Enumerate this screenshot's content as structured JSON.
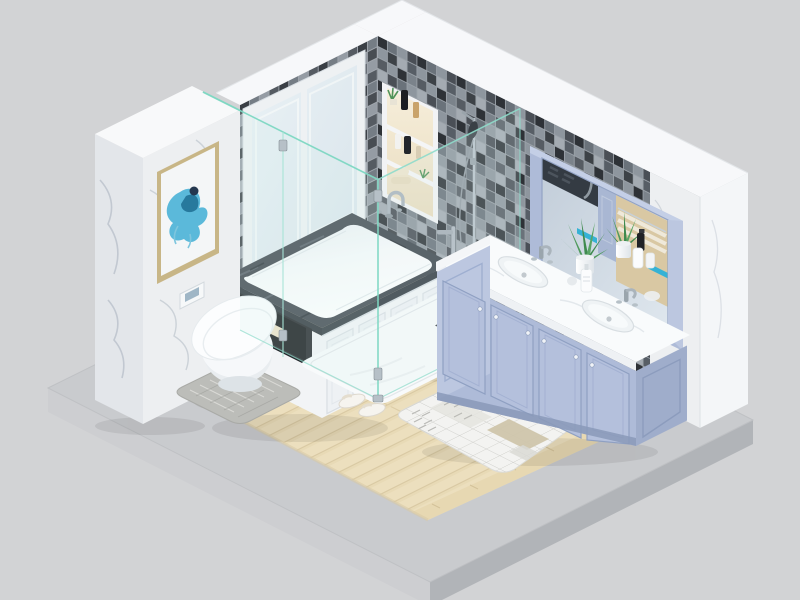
{
  "scene": {
    "kind": "3d-isometric-room-render",
    "room": "bathroom",
    "view": "isometric cutaway, two walls visible, transparent-style studio background",
    "background": "#d2d3d5"
  },
  "palette": {
    "background": "#d2d3d5",
    "slab_top": "#c9cbce",
    "slab_left": "#cdced1",
    "slab_right": "#b1b4b8",
    "wood": "#ecdfbe",
    "wood_border": "#e7d8b2",
    "wall_white": "#f1f3f5",
    "trim_white": "#f7f8fa",
    "marble_white": "#edeff1",
    "tile_grout": "#9aa1a8",
    "tub_rim_stone": "#3f464e",
    "tub_white": "#fdfefe",
    "panel_white": "#f2f4f6",
    "glass_fill": "#d6f0ec",
    "glass_edge": "#7fd8c3",
    "tray_white": "#f8fafb",
    "vanity_blue": "#aebbd8",
    "vanity_blue_dark": "#9fadcb",
    "vanity_blue_light": "#bcc7e0",
    "counter_white": "#f9fbfc",
    "mirror_glass": "#ccd6e1",
    "accent_teal": "#35b2d5",
    "plant_green": "#3f8a4e",
    "towel_cream": "#eee4cc",
    "niche_warm": "#f3e9d3",
    "chrome": "#b6c0c7",
    "gold_frame": "#c8b687",
    "rug_white": "#f3f3f1",
    "rug_beige": "#cfc5ab",
    "mat_gray": "#bcbdb9",
    "art_blue": "#4ab3d6"
  },
  "objects": {
    "platform": {
      "label": "concrete display platform",
      "material": "light gray concrete slab"
    },
    "floor": {
      "label": "wood plank floor",
      "detail": "light oak planks with beige tile border"
    },
    "left_wall": {
      "label": "marble pillar wall",
      "material": "white marble with gray veining"
    },
    "artwork": {
      "label": "framed abstract painting",
      "frame": "gold",
      "art": "blue watercolor splash"
    },
    "window": {
      "label": "double casement window",
      "frame": "white",
      "panes": 2
    },
    "back_wall": {
      "label": "mosaic tile wall",
      "detail": "black / gray checker mosaic"
    },
    "wall_niche": {
      "label": "recessed shower shelf",
      "shelves": 3,
      "items": [
        "plant",
        "black bottle",
        "amber bottle",
        "soap pumps",
        "rolled towels"
      ]
    },
    "shower": {
      "label": "glass walk-in shower",
      "detail": "frameless teal-edge glass, chrome handle, slide bar, white tray with drain"
    },
    "bathtub": {
      "label": "drop-in bathtub",
      "detail": "dark stone rim, white shaker panel skirt, chrome filler"
    },
    "tub_niche": {
      "label": "black storage niche",
      "items": [
        "rolled towel",
        "jars"
      ]
    },
    "toilet": {
      "label": "wall-hung toilet",
      "extras": [
        "flush plate",
        "gray pile mat",
        "slippers"
      ]
    },
    "vanity": {
      "label": "double sink vanity",
      "color": "periwinkle blue",
      "sinks": 2,
      "items": [
        "aloe plants",
        "soap bottles",
        "chrome faucets"
      ]
    },
    "mirror": {
      "label": "framed vanity mirror",
      "frame": "periwinkle blue",
      "reflection": [
        "mosaic wall",
        "towel shelf",
        "faucet",
        "teal accents"
      ]
    },
    "rug": {
      "label": "patchwork bath rug",
      "detail": "white-gray grid, herringbone and beige patches"
    }
  }
}
